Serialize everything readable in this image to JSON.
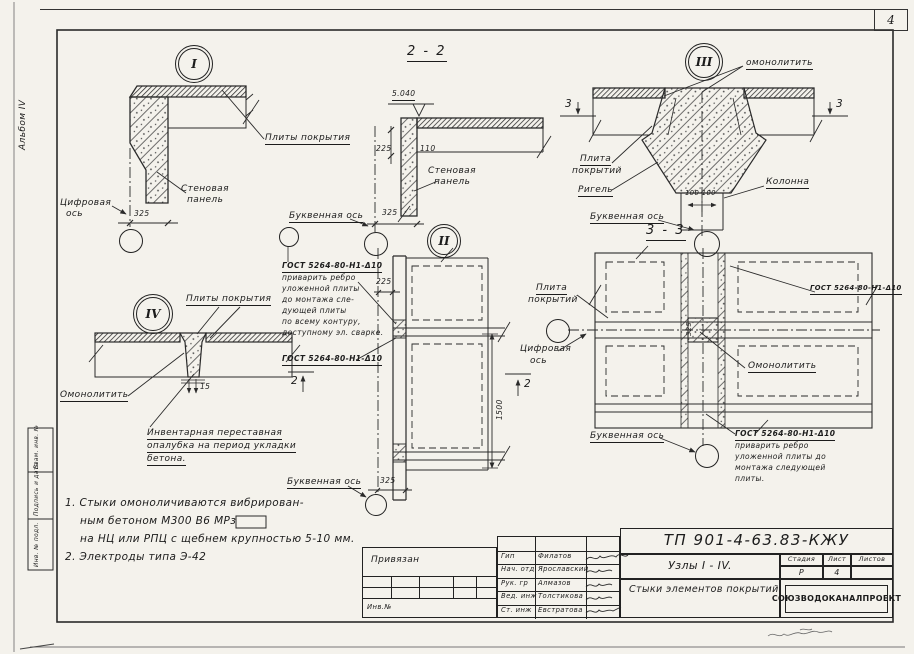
{
  "sheet": {
    "page_number": "4",
    "album": "Альбом IV",
    "stamps": {
      "top": "Взам. инв. №",
      "middle": "Подпись и дата",
      "bottom": "Инв. № подл."
    }
  },
  "node1": {
    "num": "I",
    "slab_label": "Плиты покрытия",
    "wall_label_1": "Стеновая",
    "wall_label_2": "панель",
    "axis_label_1": "Цифровая",
    "axis_label_2": "ось",
    "dim_325": "325"
  },
  "section22": {
    "title": "2 - 2",
    "elevation": "5.040",
    "dim_225": "225",
    "dim_110": "110",
    "dim_325": "325",
    "wall_label_1": "Стеновая",
    "wall_label_2": "панель",
    "axis_label": "Буквенная ось"
  },
  "node2": {
    "num": "II"
  },
  "node3": {
    "num": "III",
    "monolith_label": "омонолитить",
    "cut_mark": "3",
    "slab_label_1": "Плита",
    "slab_label_2": "покрытий",
    "girder_label": "Ригель",
    "column_label": "Колонна",
    "dim_100": "100  100",
    "axis_label": "Буквенная ось",
    "section_title": "3 - 3"
  },
  "node4": {
    "num": "IV",
    "slabs_label": "Плиты покрытия",
    "monolith_label": "Омонолитить",
    "dim_15": "15",
    "formwork_line1": "Инвентарная переставная",
    "formwork_line2": "опалубка на период укладки",
    "formwork_line3": "бетона."
  },
  "plan_left": {
    "gost_title": "ГОСТ 5264-80-Н1-Δ10",
    "weld_note_lines": [
      "приварить ребро",
      "уложенной плиты",
      "до монтажа сле-",
      "дующей плиты",
      "по всему контуру,",
      "доступному эл. сварке."
    ],
    "gost_title_2": "ГОСТ 5264-80-Н1-Δ10",
    "dim_225": "225",
    "dim_1500": "1500",
    "dim_325": "325",
    "cut_mark": "2",
    "axis_label": "Буквенная ось"
  },
  "plan_right": {
    "slab_label_1": "Плита",
    "slab_label_2": "покрытий",
    "axis_num_label_1": "Цифровая",
    "axis_num_label_2": "ось",
    "gost_top": "ГОСТ 5264-80-Н1-Δ10",
    "monolith_label": "Омонолитить",
    "dim_325": "325",
    "axis_letter_label": "Буквенная ось",
    "gost_note_title": "ГОСТ 5264-80-Н1-Δ10",
    "gost_note_lines": [
      "приварить ребро",
      "уложенной плиты до",
      "монтажа следующей",
      "плиты."
    ]
  },
  "notes": {
    "line1": "1.  Стыки  омоноличиваются  вибрирован-",
    "line2": "ным  бетоном  М300  В6  МРз",
    "line3": "на  НЦ  или  РПЦ  с  щебнем  крупностью  5-10 мм.",
    "line4": "2.  Электроды  типа  Э-42"
  },
  "title_block": {
    "privyazan": "Привязан",
    "inv_no": "Инв.№",
    "doc_number": "ТП 901-4-63.83-КЖУ",
    "subject_line1": "Узлы  I - IV.",
    "subject_line2": "Стыки  элементов  покрытий",
    "stage_label": "Стадия",
    "sheet_label": "Лист",
    "sheets_label": "Листов",
    "stage_value": "Р",
    "sheet_value": "4",
    "organization": "СОЮЗВОДОКАНАЛПРОЕКТ",
    "roles": [
      {
        "role": "Гип",
        "name": "Филатов"
      },
      {
        "role": "Нач. отд",
        "name": "Ярославский"
      },
      {
        "role": "Рук. гр",
        "name": "Алмазов"
      },
      {
        "role": "Вед. инж",
        "name": "Толстикова"
      },
      {
        "role": "Ст. инж",
        "name": "Евстратова"
      }
    ]
  }
}
